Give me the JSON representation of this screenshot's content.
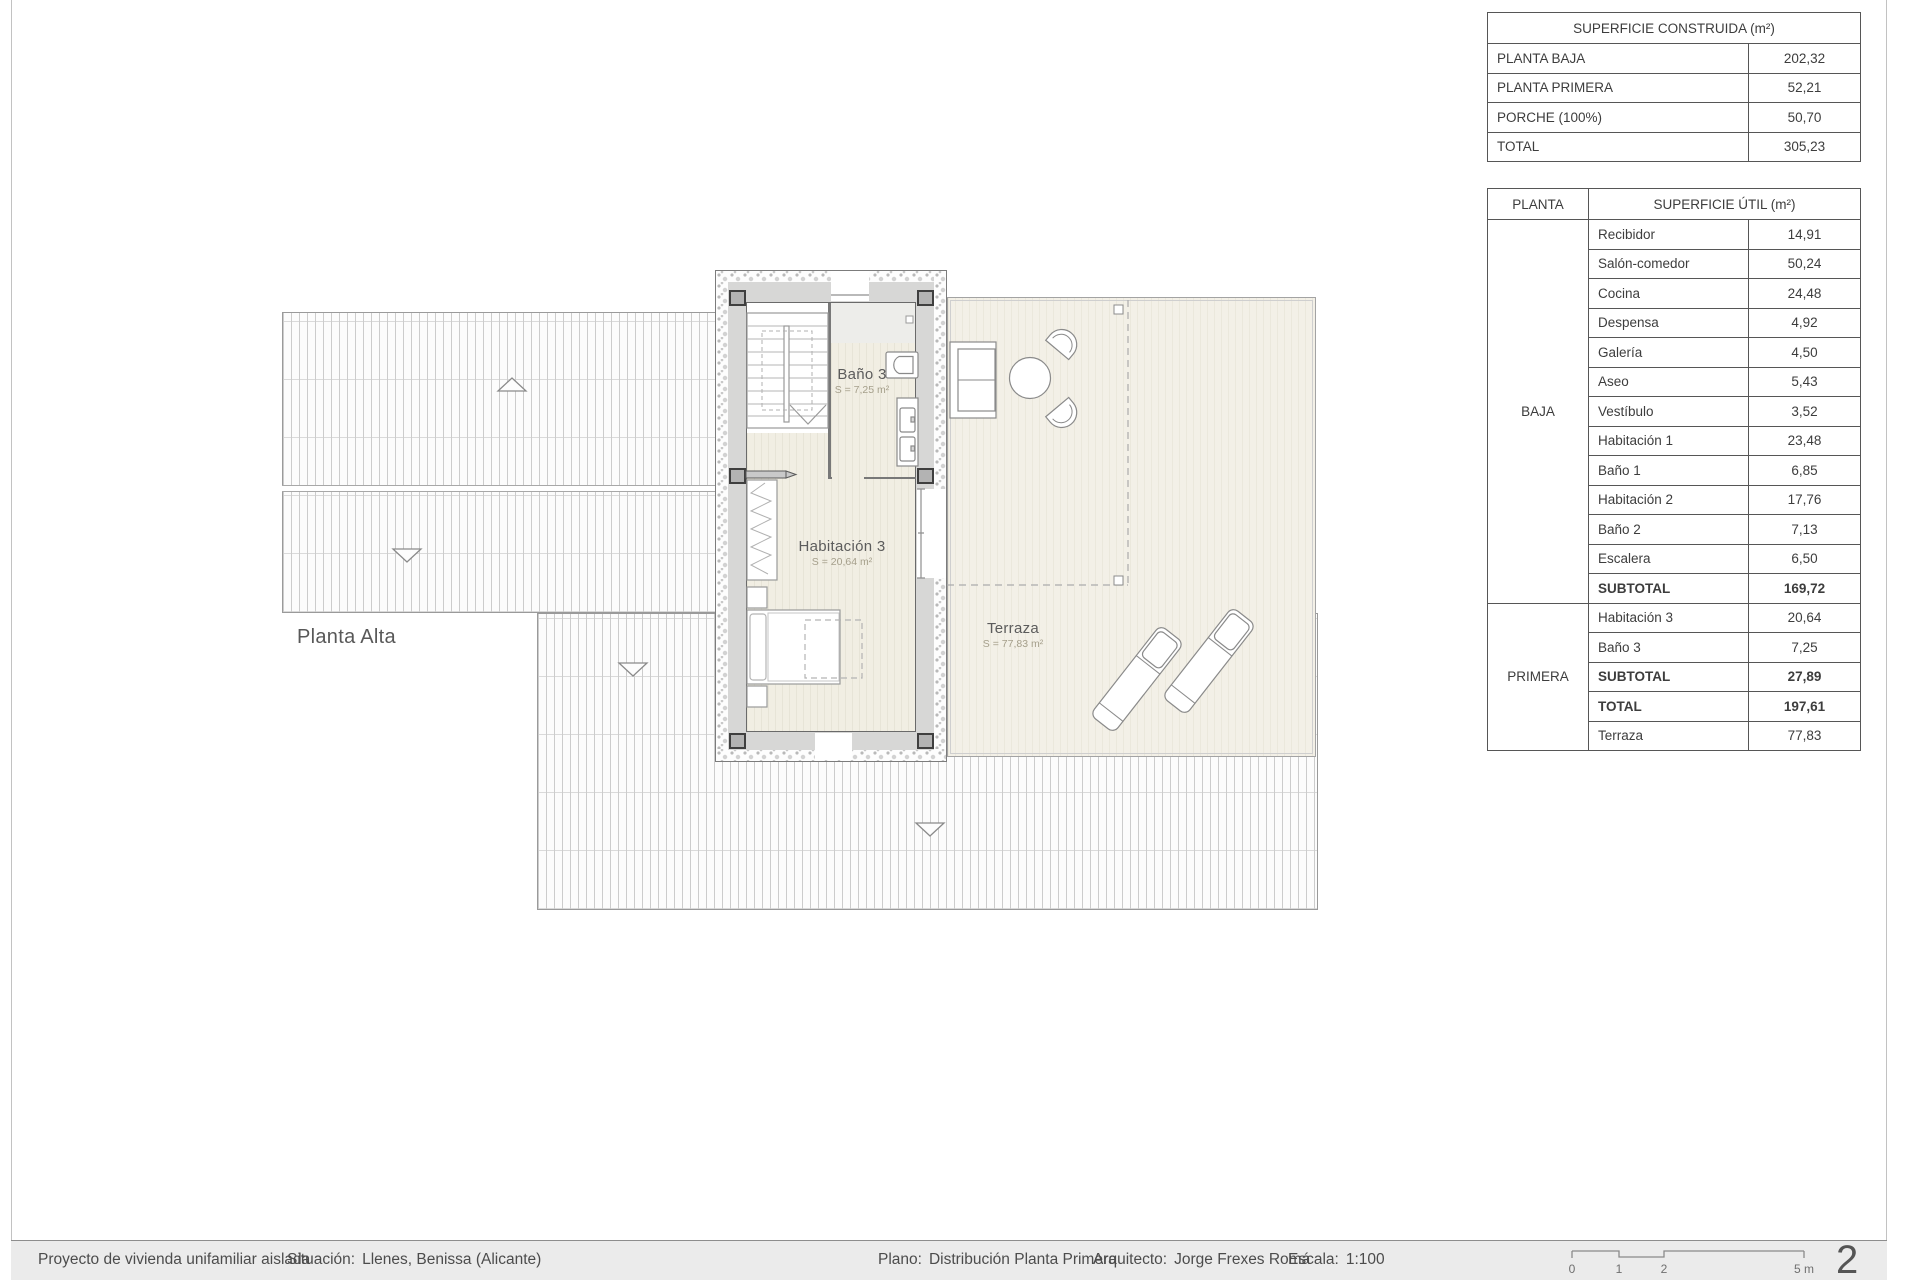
{
  "tables": {
    "construida": {
      "title": "SUPERFICIE CONSTRUIDA (m²)",
      "rows": [
        {
          "label": "PLANTA BAJA",
          "value": "202,32"
        },
        {
          "label": "PLANTA PRIMERA",
          "value": "52,21"
        },
        {
          "label": "PORCHE (100%)",
          "value": "50,70"
        },
        {
          "label": "TOTAL",
          "value": "305,23"
        }
      ]
    },
    "util": {
      "planta_header": "PLANTA",
      "title": "SUPERFICIE ÚTIL (m²)",
      "groups": [
        {
          "name": "BAJA",
          "rows": [
            {
              "label": "Recibidor",
              "value": "14,91"
            },
            {
              "label": "Salón-comedor",
              "value": "50,24"
            },
            {
              "label": "Cocina",
              "value": "24,48"
            },
            {
              "label": "Despensa",
              "value": "4,92"
            },
            {
              "label": "Galería",
              "value": "4,50"
            },
            {
              "label": "Aseo",
              "value": "5,43"
            },
            {
              "label": "Vestíbulo",
              "value": "3,52"
            },
            {
              "label": "Habitación 1",
              "value": "23,48"
            },
            {
              "label": "Baño 1",
              "value": "6,85"
            },
            {
              "label": "Habitación 2",
              "value": "17,76"
            },
            {
              "label": "Baño 2",
              "value": "7,13"
            },
            {
              "label": "Escalera",
              "value": "6,50"
            },
            {
              "label": "SUBTOTAL",
              "value": "169,72"
            }
          ]
        },
        {
          "name": "PRIMERA",
          "rows": [
            {
              "label": "Habitación 3",
              "value": "20,64"
            },
            {
              "label": "Baño 3",
              "value": "7,25"
            },
            {
              "label": "SUBTOTAL",
              "value": "27,89"
            },
            {
              "label": "TOTAL",
              "value": "197,61"
            },
            {
              "label": "Terraza",
              "value": "77,83"
            }
          ]
        }
      ]
    }
  },
  "plan": {
    "floor_label": "Planta Alta",
    "bano3_name": "Baño 3",
    "bano3_area": "S = 7,25 m²",
    "hab3_name": "Habitación 3",
    "hab3_area": "S = 20,64 m²",
    "terraza_name": "Terraza",
    "terraza_area": "S = 77,83 m²"
  },
  "footer": {
    "project_label": "Proyecto de vivienda unifamiliar aislada",
    "situacion_label": "Situación:",
    "situacion_value": "Llenes, Benissa (Alicante)",
    "plano_label": "Plano:",
    "plano_value": "Distribución Planta Primera",
    "arquitecto_label": "Arquitecto:",
    "arquitecto_value": "Jorge Frexes Romá",
    "escala_label": "Escala:",
    "escala_value": "1:100",
    "scale_tick_0": "0",
    "scale_tick_1": "1",
    "scale_tick_2": "2",
    "scale_tick_5": "5 m",
    "page_number": "2"
  },
  "colors": {
    "floor_beige": "#f1eee3",
    "terrace_beige": "#f3f0e7",
    "wall_gray": "#d7d7d6",
    "column_gray": "#b3b3b3",
    "line_gray": "#8c8c8c",
    "footer_gray": "#ebebeb"
  }
}
